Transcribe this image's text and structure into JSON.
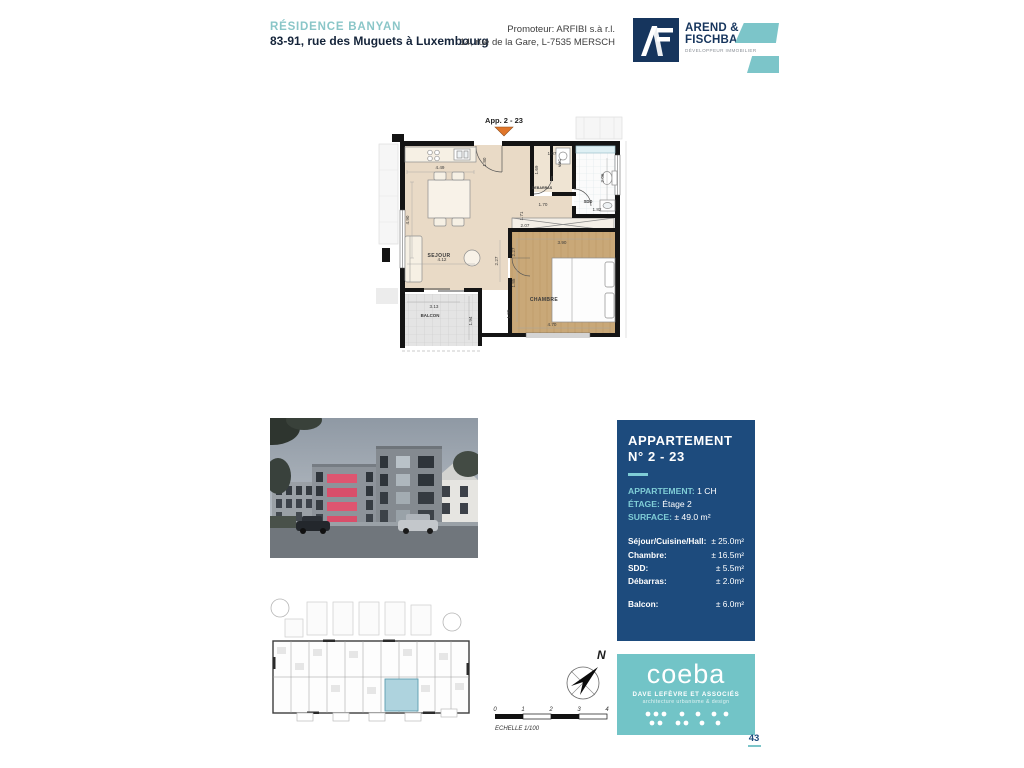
{
  "header": {
    "residence": "RÉSIDENCE BANYAN",
    "address": "83-91, rue des Muguets à Luxembourg",
    "promoter_line1": "Promoteur: ARFIBI s.à r.l.",
    "promoter_line2": "14, rue de la Gare, L-7535 MERSCH",
    "logo": {
      "name_line1": "AREND &",
      "name_line2": "FISCHBACH",
      "tagline": "DÉVELOPPEUR IMMOBILIER"
    }
  },
  "plan": {
    "apartment_label": "App. 2 - 23",
    "labels": {
      "sejour": "SEJOUR",
      "chambre": "CHAMBRE",
      "balcon": "BALCON",
      "debarras": "DEBARRAS",
      "vmc": "VMC",
      "sdd": "SDD"
    },
    "dims": {
      "sejour_top": "4.49",
      "sejour_left": "4.90",
      "sejour_bottom": "4.12",
      "hall_right": "1.80",
      "hall_w1": "1.70",
      "hall_h1": "1.71",
      "hall_w2": "2.07",
      "hall_mid": "2.27",
      "debarras_top": "1.07",
      "debarras_left": "1.69",
      "sdd_right": "2.06",
      "sdd_bottom": "1.82",
      "chambre_top": "3.90",
      "chambre_left1": "2.27",
      "chambre_left2": "1.85",
      "chambre_left3": "1.98",
      "chambre_bottom": "4.70",
      "balcon_top": "3.13",
      "balcon_right": "1.94"
    }
  },
  "panel": {
    "title_line1": "APPARTEMENT",
    "title_line2": "N° 2 - 23",
    "fields": [
      {
        "label": "APPARTEMENT:",
        "value": " 1 CH"
      },
      {
        "label": "ÉTAGE:",
        "value": " Étage 2"
      },
      {
        "label": "SURFACE:",
        "value": " ± 49.0 m²"
      }
    ],
    "rooms": [
      {
        "label": "Séjour/Cuisine/Hall:",
        "value": "± 25.0m²"
      },
      {
        "label": "Chambre:",
        "value": "± 16.5m²"
      },
      {
        "label": "SDD:",
        "value": "± 5.5m²"
      },
      {
        "label": "Débarras:",
        "value": "± 2.0m²"
      },
      {
        "label": "Balcon:",
        "value": "± 6.0m²"
      }
    ]
  },
  "legend": {
    "north": "N",
    "scale_ticks": [
      "0",
      "1",
      "2",
      "3",
      "4"
    ],
    "scale_label": "ECHELLE 1/100"
  },
  "coeba": {
    "name": "coeba",
    "line1": "DAVE LEFÈVRE ET ASSOCIÉS",
    "line2": "architecture urbanisme & design"
  },
  "page_number": "43",
  "colors": {
    "teal": "#7cc5c9",
    "navy": "#1d4b7d",
    "logo_navy": "#16355d",
    "accent_orange": "#e0762a",
    "balcony_pink": "#de5570",
    "floor_beige": "#e9dac6",
    "floor_wood": "#c9a878",
    "site_highlight": "#aed3de"
  }
}
